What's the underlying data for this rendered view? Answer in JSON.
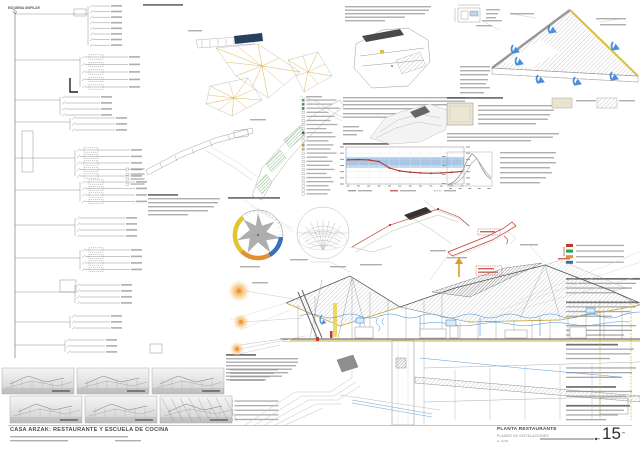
{
  "sheet": {
    "titleblock": {
      "project_title": "CASA ARZAK: RESTAURANTE Y ESCUELA DE COCINA",
      "plan_title": "PLANTA RESTAURANTE",
      "plan_subtitle": "PLANOS DE INSTALACIONES",
      "scale": "E: 1/200",
      "sheet_number": "15"
    },
    "panels": {
      "unifilar_title": "ESQUEMA UNIFILAR",
      "climate_info_marker": "i"
    },
    "legend_colors": [
      "#c0392b",
      "#2e9e52",
      "#e0922e",
      "#2e6fbb"
    ],
    "plan_legend_icon_colors": [
      "#2e9e52",
      "#2e9e52",
      "#3a8a3a",
      "none",
      "none",
      "none",
      "none",
      "none",
      "#555555",
      "none",
      "none",
      "#e0922e",
      "#d8c040",
      "none",
      "none",
      "none",
      "none",
      "none",
      "none",
      "none",
      "none",
      "none",
      "none",
      "none"
    ],
    "colors": {
      "accent_yellow": "#d4b23c",
      "accent_navy": "#27405f",
      "accent_blue": "#4a90d8",
      "accent_red": "#c0392b",
      "accent_orange": "#e0922e",
      "accent_green": "#2e9e52",
      "comfort_band_blue": "#c3d9ef",
      "sun_orange": "#f2a83c",
      "roof_hatch_gray": "#b5b5b5"
    }
  },
  "chart_data": [
    {
      "type": "line",
      "name": "comfort-temperature-chart",
      "x": [
        "1",
        "2",
        "3",
        "4",
        "5",
        "6",
        "7",
        "8",
        "9",
        "10",
        "11",
        "12"
      ],
      "series": [
        {
          "name": "temperatura",
          "color": "#b03a2e",
          "values": [
            19.6,
            19.8,
            19.5,
            18.2,
            13.0,
            10.6,
            9.6,
            9.0,
            8.7,
            9.0,
            9.5,
            10.2
          ]
        }
      ],
      "comfort_band": {
        "min": 13,
        "max": 22,
        "inner_min": 15,
        "inner_max": 21,
        "color": "#c3d9ef",
        "inner_color": "#a9c6e6"
      },
      "ylim": [
        0,
        30
      ],
      "grid": true,
      "legend_entries": 3
    },
    {
      "type": "line",
      "name": "distribution-curves-chart",
      "series": [
        {
          "name": "curve-1",
          "color": "#8f8f8f",
          "values": [
            4,
            10,
            22,
            42,
            75,
            95,
            82,
            55,
            32,
            20
          ]
        },
        {
          "name": "curve-2",
          "color": "#b5b5b5",
          "values": [
            2,
            5,
            12,
            24,
            45,
            68,
            80,
            62,
            40,
            26
          ]
        }
      ],
      "ylim": [
        0,
        100
      ],
      "grid": false
    },
    {
      "type": "windrose",
      "name": "wind-rose",
      "segments": [
        {
          "from": 225,
          "to": 320,
          "color": "#e3c62f"
        },
        {
          "from": 150,
          "to": 225,
          "color": "#e0922e"
        },
        {
          "from": 95,
          "to": 150,
          "color": "#3a6fbf"
        }
      ]
    }
  ]
}
